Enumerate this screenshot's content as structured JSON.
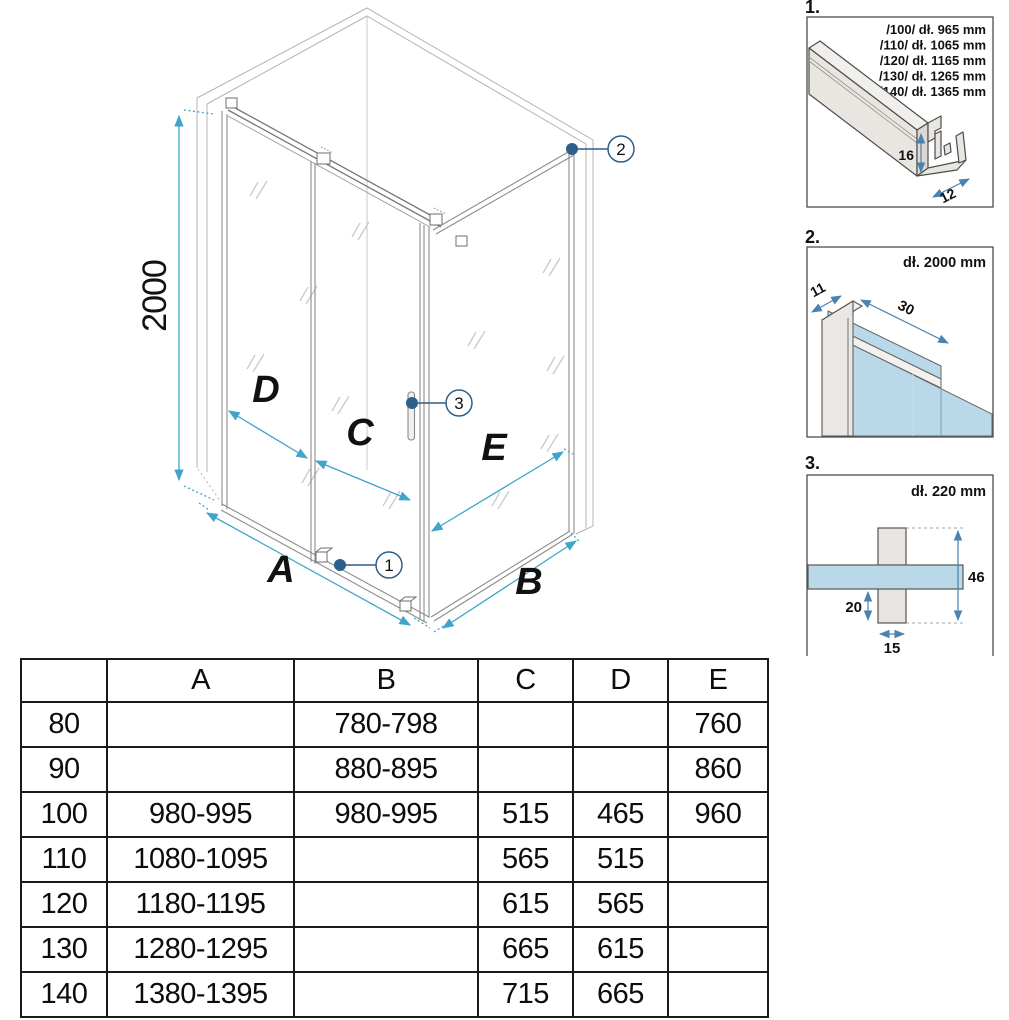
{
  "main": {
    "height_dim": "2000",
    "dims": {
      "a": "A",
      "b": "B",
      "c": "C",
      "d": "D",
      "e": "E"
    },
    "callouts": {
      "c1": "1",
      "c2": "2",
      "c3": "3"
    }
  },
  "details": {
    "d1": {
      "label": "1.",
      "size_lines": [
        "/100/ dł. 965 mm",
        "/110/ dł. 1065 mm",
        "/120/ dł. 1165 mm",
        "/130/ dł. 1265 mm",
        "/140/ dł. 1365 mm"
      ],
      "dim_height": "16",
      "dim_depth": "12"
    },
    "d2": {
      "label": "2.",
      "length": "dł. 2000 mm",
      "dim_width": "11",
      "dim_depth": "30"
    },
    "d3": {
      "label": "3.",
      "length": "dł. 220 mm",
      "dim_height": "46",
      "dim_offset": "20",
      "dim_width": "15"
    }
  },
  "colors": {
    "dim_arrow_main": "#41a4cb",
    "dim_arrow_detail": "#4a82b0",
    "callout_blue": "#2d5f8a",
    "glass_blue": "#b9d9e9",
    "profile_fill": "#e9e6e2",
    "frame_gray": "#b4b4b4",
    "table_border": "#1a1a1a"
  },
  "table": {
    "headers": [
      "",
      "A",
      "B",
      "C",
      "D",
      "E"
    ],
    "rows": [
      {
        "size": "80",
        "a": "",
        "b": "780-798",
        "c": "",
        "d": "",
        "e": "760"
      },
      {
        "size": "90",
        "a": "",
        "b": "880-895",
        "c": "",
        "d": "",
        "e": "860"
      },
      {
        "size": "100",
        "a": "980-995",
        "b": "980-995",
        "c": "515",
        "d": "465",
        "e": "960"
      },
      {
        "size": "110",
        "a": "1080-1095",
        "b": "",
        "c": "565",
        "d": "515",
        "e": ""
      },
      {
        "size": "120",
        "a": "1180-1195",
        "b": "",
        "c": "615",
        "d": "565",
        "e": ""
      },
      {
        "size": "130",
        "a": "1280-1295",
        "b": "",
        "c": "665",
        "d": "615",
        "e": ""
      },
      {
        "size": "140",
        "a": "1380-1395",
        "b": "",
        "c": "715",
        "d": "665",
        "e": ""
      }
    ]
  }
}
